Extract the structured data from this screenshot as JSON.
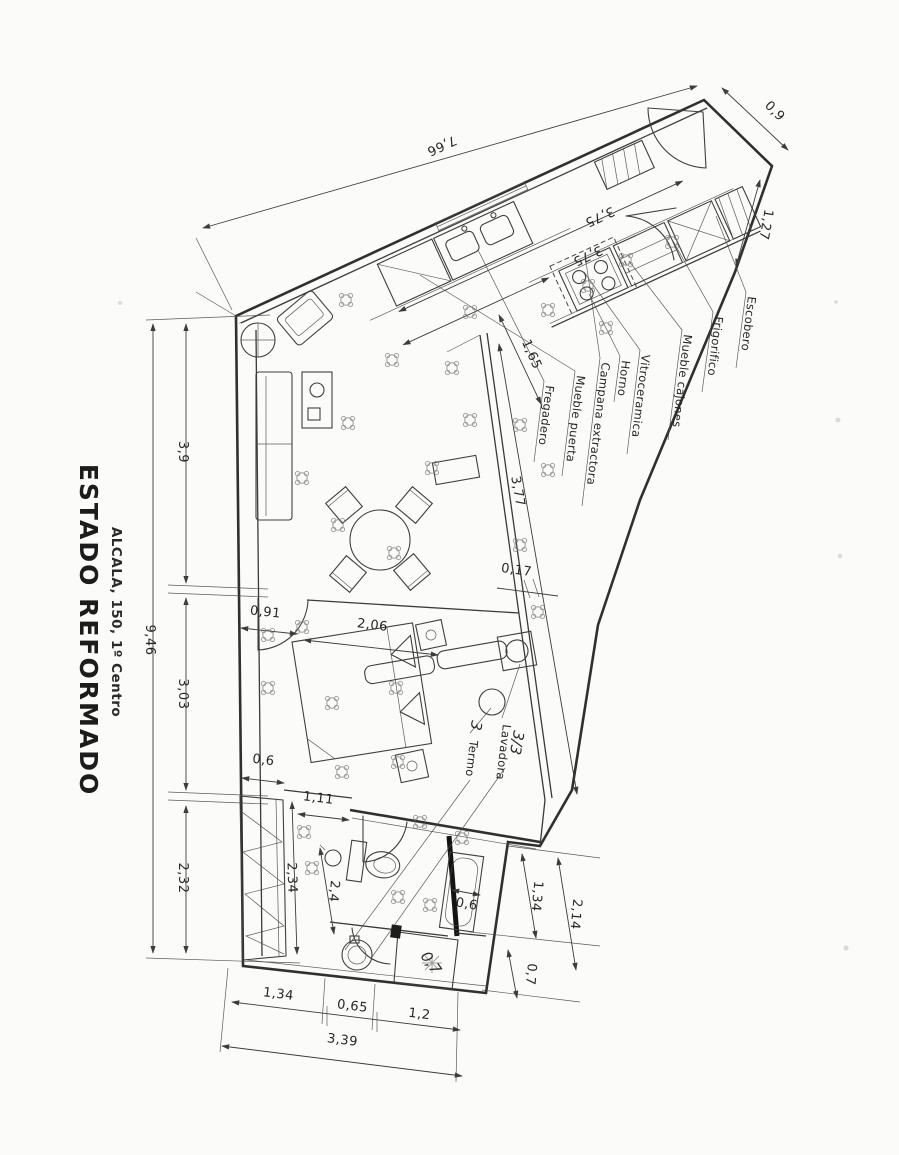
{
  "title_block": {
    "title": "ESTADO REFORMADO",
    "subtitle": "ALCALA, 150, 1º Centro"
  },
  "dims": {
    "top_total": "7,66",
    "entry_width": "0,9",
    "escobero_depth": "1,27",
    "kitchen_a": "3,75",
    "kitchen_b": "3,75",
    "counter_return": "1,65",
    "left_total": "9,46",
    "left_top": "3,9",
    "left_mid": "3,03",
    "left_bottom": "2,32",
    "corridor_wall": "3,77",
    "wall_gap": "0,17",
    "bedroom_door": "0,91",
    "bed_width": "2,06",
    "closet_width": "0,6",
    "closet_length": "2,34",
    "hall_pass": "1,11",
    "bath_width": "2,4",
    "tub_width": "0,6",
    "bath_right_inner": "1,34",
    "bath_right_total": "2,14",
    "bath_right_lower": "0,7",
    "shower_note": "0,7",
    "bottom_a": "1,34",
    "bottom_b": "0,65",
    "bottom_c": "1,2",
    "bottom_total": "3,39"
  },
  "kitchen_labels": [
    "Escobero",
    "Frigorifico",
    "Mueble cajones",
    "Vitroceramica",
    "Horno",
    "Campana extractora",
    "Mueble puerta",
    "Fregadero"
  ],
  "utility_labels": {
    "termo": "Termo",
    "lavadora": "Lavadora"
  },
  "annotations": {
    "fraction": "3/3",
    "count": "3"
  },
  "colors": {
    "ink": "#3a3a3a",
    "paper": "#fbfbf9"
  }
}
